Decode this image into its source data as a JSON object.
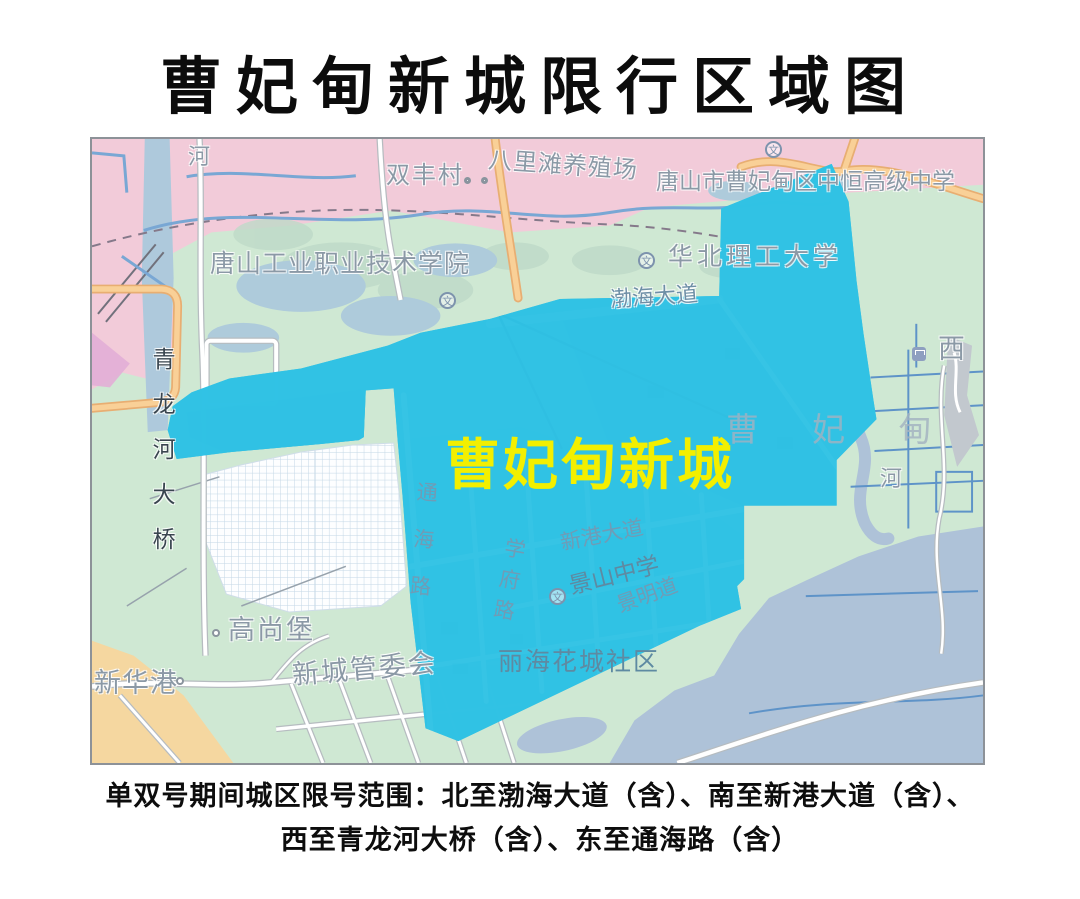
{
  "title": "曹妃甸新城限行区域图",
  "map": {
    "zone_label": "曹妃甸新城",
    "watermark_gray": "曹 妃 甸",
    "watermark_pink": "新 城",
    "school_icon_glyph": "文",
    "labels": {
      "river_top": "河",
      "shuangfeng_village": "双丰村",
      "balitan_farm": "八里滩养殖场",
      "zhongheng_school": "唐山市曹妃甸区中恒高级中学",
      "tangshan_college": "唐山工业职业技术学院",
      "huabei_university": "华北理工大学",
      "bohai_avenue": "渤海大道",
      "qinglonghe_bridge": "青龙河大桥",
      "gaoshangbao": "高尚堡",
      "xinhuagang": "新华港",
      "xincheng_committee": "新城管委会",
      "lihai_community": "丽海花城社区",
      "jingshan_school": "景山中学",
      "xingang_avenue": "新港大道",
      "jingming_road": "景明道",
      "xuefu_road": "学府路",
      "tonghai_road": "通海路",
      "river_right": "河",
      "west_station": "西"
    },
    "colors": {
      "boundary": "#e2063f",
      "zone_fill": "#30c2e4",
      "zone_label_color": "#f3ef00",
      "pink_area": "#f2cbd9",
      "green_area": "#cfe8d3",
      "water": "#aec2d8",
      "orange_road": "#f9d097"
    }
  },
  "caption": {
    "line1": "单双号期间城区限号范围：北至渤海大道（含）、南至新港大道（含）、",
    "line2": "西至青龙河大桥（含）、东至通海路（含）"
  }
}
